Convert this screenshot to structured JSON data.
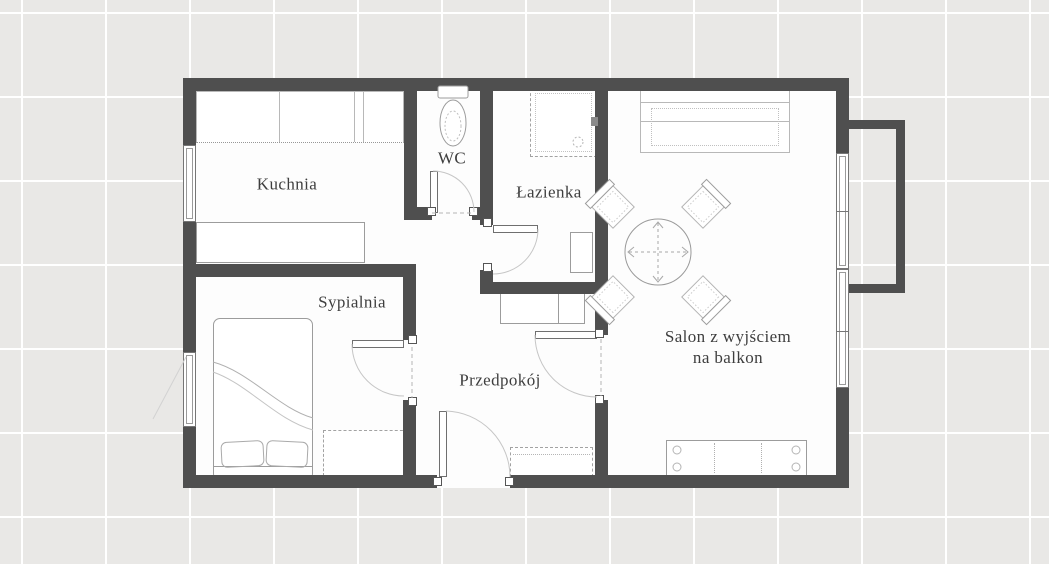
{
  "page": {
    "type": "apartment-floor-plan"
  },
  "rooms": {
    "kitchen": {
      "label": "Kuchnia"
    },
    "wc": {
      "label": "WC"
    },
    "bathroom": {
      "label": "Łazienka"
    },
    "bedroom": {
      "label": "Sypialnia"
    },
    "hallway": {
      "label": "Przedpokój"
    },
    "living_room": {
      "label": "Salon z wyjściem na balkon",
      "label_line1": "Salon z wyjściem",
      "label_line2": "na balkon"
    }
  },
  "colors": {
    "wall": "#4f4f4f",
    "floor": "#fdfdfd",
    "background": "#e9e8e6",
    "grid_line": "#ffffff",
    "furniture_line": "#9c9c9c",
    "text": "#3e3e3e"
  }
}
